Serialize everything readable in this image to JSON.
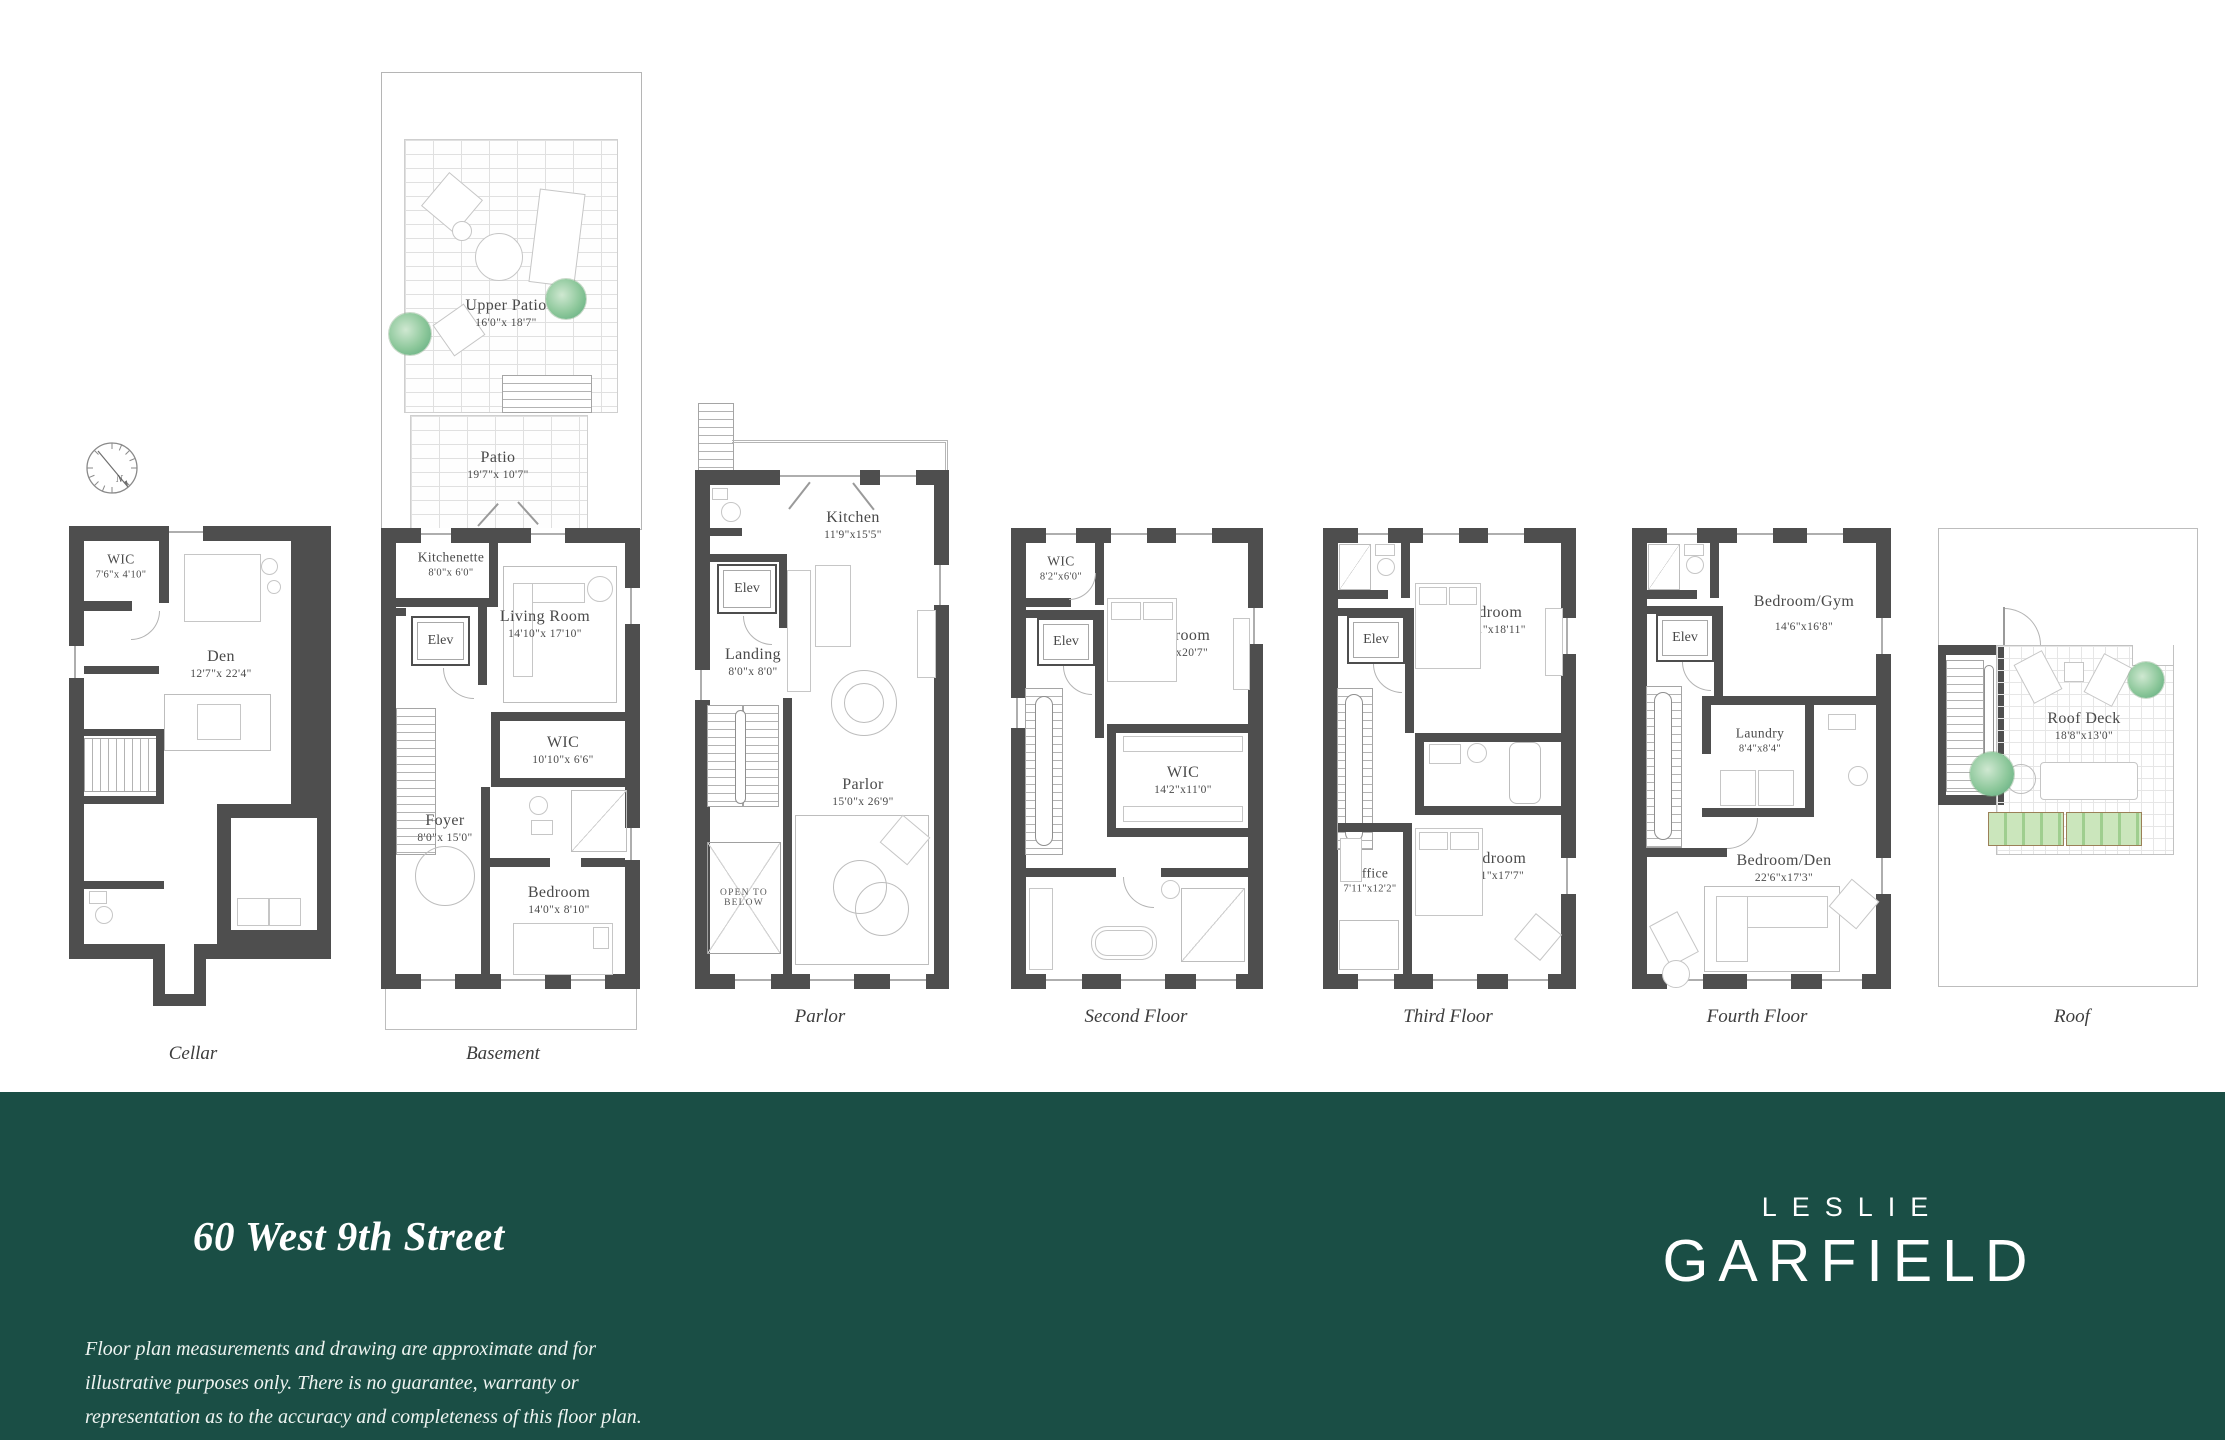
{
  "address": "60 West 9th Street",
  "disclaimer": [
    "Floor plan measurements and drawing are approximate and for",
    "illustrative purposes only. There is no guarantee, warranty or",
    "representation as to the accuracy and completeness of this floor plan."
  ],
  "brand": {
    "line1": "LESLIE",
    "line2": "GARFIELD"
  },
  "compass": {
    "label": "N"
  },
  "colors": {
    "footer_green": "#1a4e45",
    "wall_gray": "#4e4e4e",
    "plant_green": "#8cc79a"
  },
  "floors": [
    {
      "caption": "Cellar",
      "rooms": [
        {
          "name": "WIC",
          "dims": "7'6\"x 4'10\""
        },
        {
          "name": "Den",
          "dims": "12'7\"x 22'4\""
        }
      ]
    },
    {
      "caption": "Basement",
      "outdoor": [
        {
          "name": "Upper Patio",
          "dims": "16'0\"x 18'7\""
        },
        {
          "name": "Patio",
          "dims": "19'7\"x 10'7\""
        }
      ],
      "rooms": [
        {
          "name": "Kitchenette",
          "dims": "8'0\"x 6'0\""
        },
        {
          "name": "Elev"
        },
        {
          "name": "Living Room",
          "dims": "14'10\"x 17'10\""
        },
        {
          "name": "WIC",
          "dims": "10'10\"x 6'6\""
        },
        {
          "name": "Foyer",
          "dims": "8'0\"x 15'0\""
        },
        {
          "name": "Bedroom",
          "dims": "14'0\"x 8'10\""
        }
      ]
    },
    {
      "caption": "Parlor",
      "rooms": [
        {
          "name": "Kitchen",
          "dims": "11'9\"x15'5\""
        },
        {
          "name": "Elev"
        },
        {
          "name": "Landing",
          "dims": "8'0\"x 8'0\""
        },
        {
          "name": "Parlor",
          "dims": "15'0\"x 26'9\""
        },
        {
          "name": "OPEN TO BELOW"
        }
      ]
    },
    {
      "caption": "Second Floor",
      "rooms": [
        {
          "name": "WIC",
          "dims": "8'2\"x6'0\""
        },
        {
          "name": "Bedroom",
          "dims": "14'9\"x20'7\""
        },
        {
          "name": "Elev"
        },
        {
          "name": "WIC",
          "dims": "14'2\"x11'0\""
        }
      ]
    },
    {
      "caption": "Third Floor",
      "rooms": [
        {
          "name": "Elev"
        },
        {
          "name": "Bedroom",
          "dims": "14'11\"x18'11\""
        },
        {
          "name": "Bedroom",
          "dims": "15'1\"x17'7\""
        },
        {
          "name": "Office",
          "dims": "7'11\"x12'2\""
        }
      ]
    },
    {
      "caption": "Fourth Floor",
      "rooms": [
        {
          "name": "Elev"
        },
        {
          "name": "Bedroom/Gym",
          "dims": "14'6\"x16'8\""
        },
        {
          "name": "Laundry",
          "dims": "8'4\"x8'4\""
        },
        {
          "name": "Bedroom/Den",
          "dims": "22'6\"x17'3\""
        }
      ]
    },
    {
      "caption": "Roof",
      "rooms": [
        {
          "name": "Roof Deck",
          "dims": "18'8\"x13'0\""
        }
      ]
    }
  ]
}
